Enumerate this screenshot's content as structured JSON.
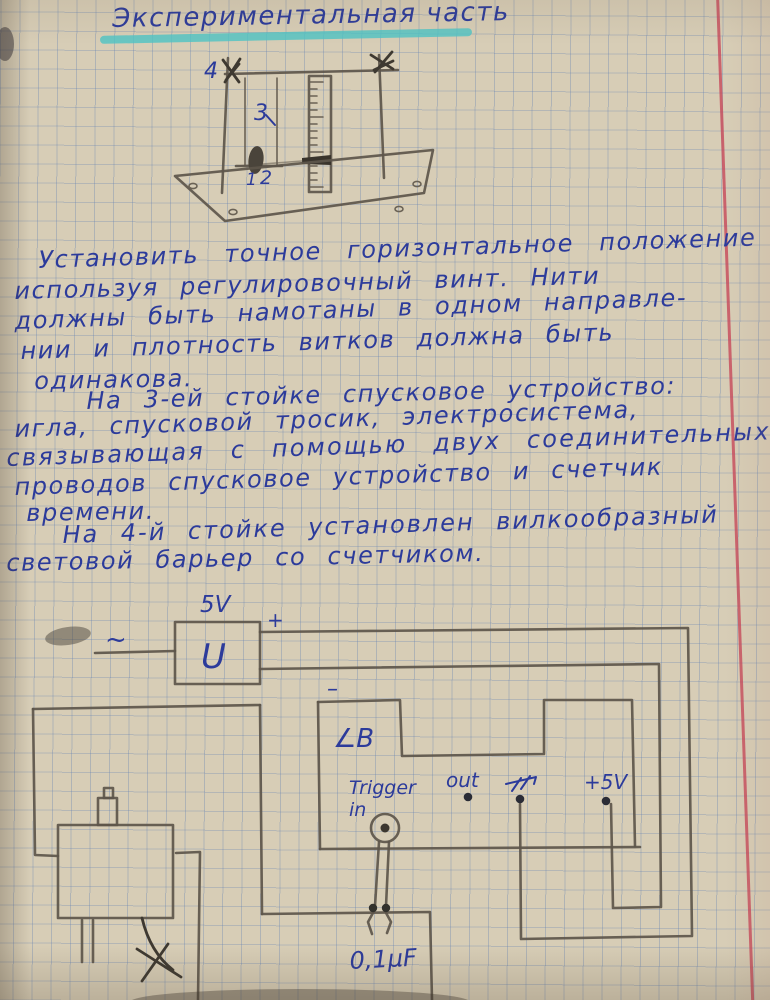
{
  "notebook": {
    "title": "Экспериментальная часть",
    "body_lines": [
      "Установить точное горизонтальное положение",
      "используя регулировочный винт. Нити",
      "должны быть намотаны в одном направле-",
      "нии и плотность витков должна быть",
      "одинакова.",
      "На 3-ей стойке спусковое устройство:",
      "игла, спусковой тросик, электросистема,",
      "связывающая с помощью двух соединительных",
      "проводов спусковое устройство и счетчик",
      "времени.",
      "На 4-й стойке установлен вилкообразный",
      "световой барьер со счетчиком."
    ],
    "apparatus": {
      "label_4": "4",
      "label_3": "3",
      "label_1": "1",
      "label_2": "2"
    },
    "circuit": {
      "voltage": "5V",
      "ac": "~",
      "source": "U",
      "plus": "+",
      "minus": "–",
      "light_barrier": "∠B",
      "trigger_line1": "Trigger",
      "trigger_line2": "in",
      "out": "out",
      "plus_5v": "+5V",
      "capacitor": "0,1µF"
    },
    "colors": {
      "ink": "#2c3b9b",
      "pencil": "#5d564b",
      "highlight": "#4ec4c6",
      "margin_line": "#c7485a",
      "paper": "#d7cdb6",
      "grid": "#6280b2"
    }
  }
}
